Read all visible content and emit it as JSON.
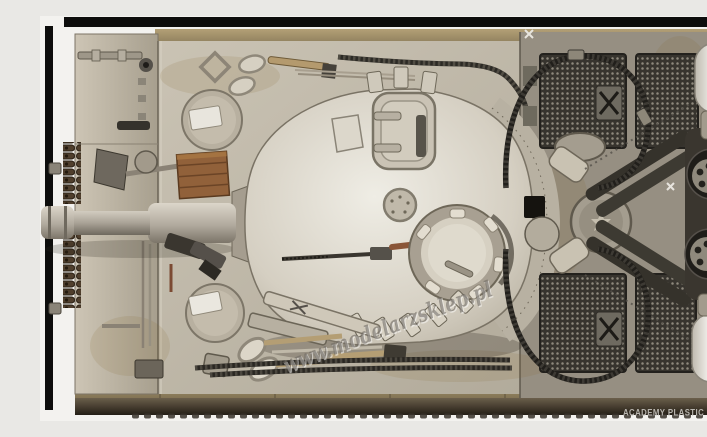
{
  "meta": {
    "subject": "Built and weathered plastic model of a Tiger I heavy tank, photographed from directly above (top view), gun barrel pointing left",
    "brand": "Academy"
  },
  "watermark": {
    "text": "www.modelarzsklep.pl",
    "color": "#6e6962"
  },
  "caption": {
    "text": "ACADEMY PLASTIC MODEL",
    "color": "#b8b5af"
  },
  "palette": {
    "background": "#f3f2ef",
    "frame": "#0d0d0c",
    "hull_deck": "#c3bcae",
    "fender_tan": "#ac9a71",
    "turret": "#d8d3c7",
    "engine_deck": "#968f82",
    "grille_mesh": "#3c3933",
    "tow_cable": "#24221d",
    "air_cleaner_canister": "#e7e4de",
    "wooden_crate": "#91613a",
    "shadow_band": "#2a241d"
  }
}
